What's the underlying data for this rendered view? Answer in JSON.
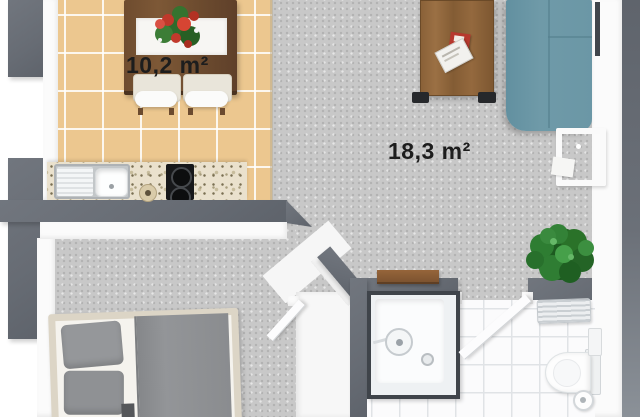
{
  "floorplan": {
    "kitchen_dining": {
      "area_label": "10,2 m²"
    },
    "living_room": {
      "area_label": "18,3 m²"
    }
  },
  "colors": {
    "wall-dark": "#676c74",
    "kitchen-tile": "#ecc78f",
    "carpet": "#c8c8c8",
    "bath-floor": "#fbfbfc",
    "granite": "#eae1cd",
    "sofa": "#6f9aa8",
    "wood-table": "#7d5836",
    "bed-frame": "#dcd5c6",
    "textile-gray": "#8f9194",
    "plant-green": "#2e7d32",
    "label-text": "#1d1d1d"
  }
}
